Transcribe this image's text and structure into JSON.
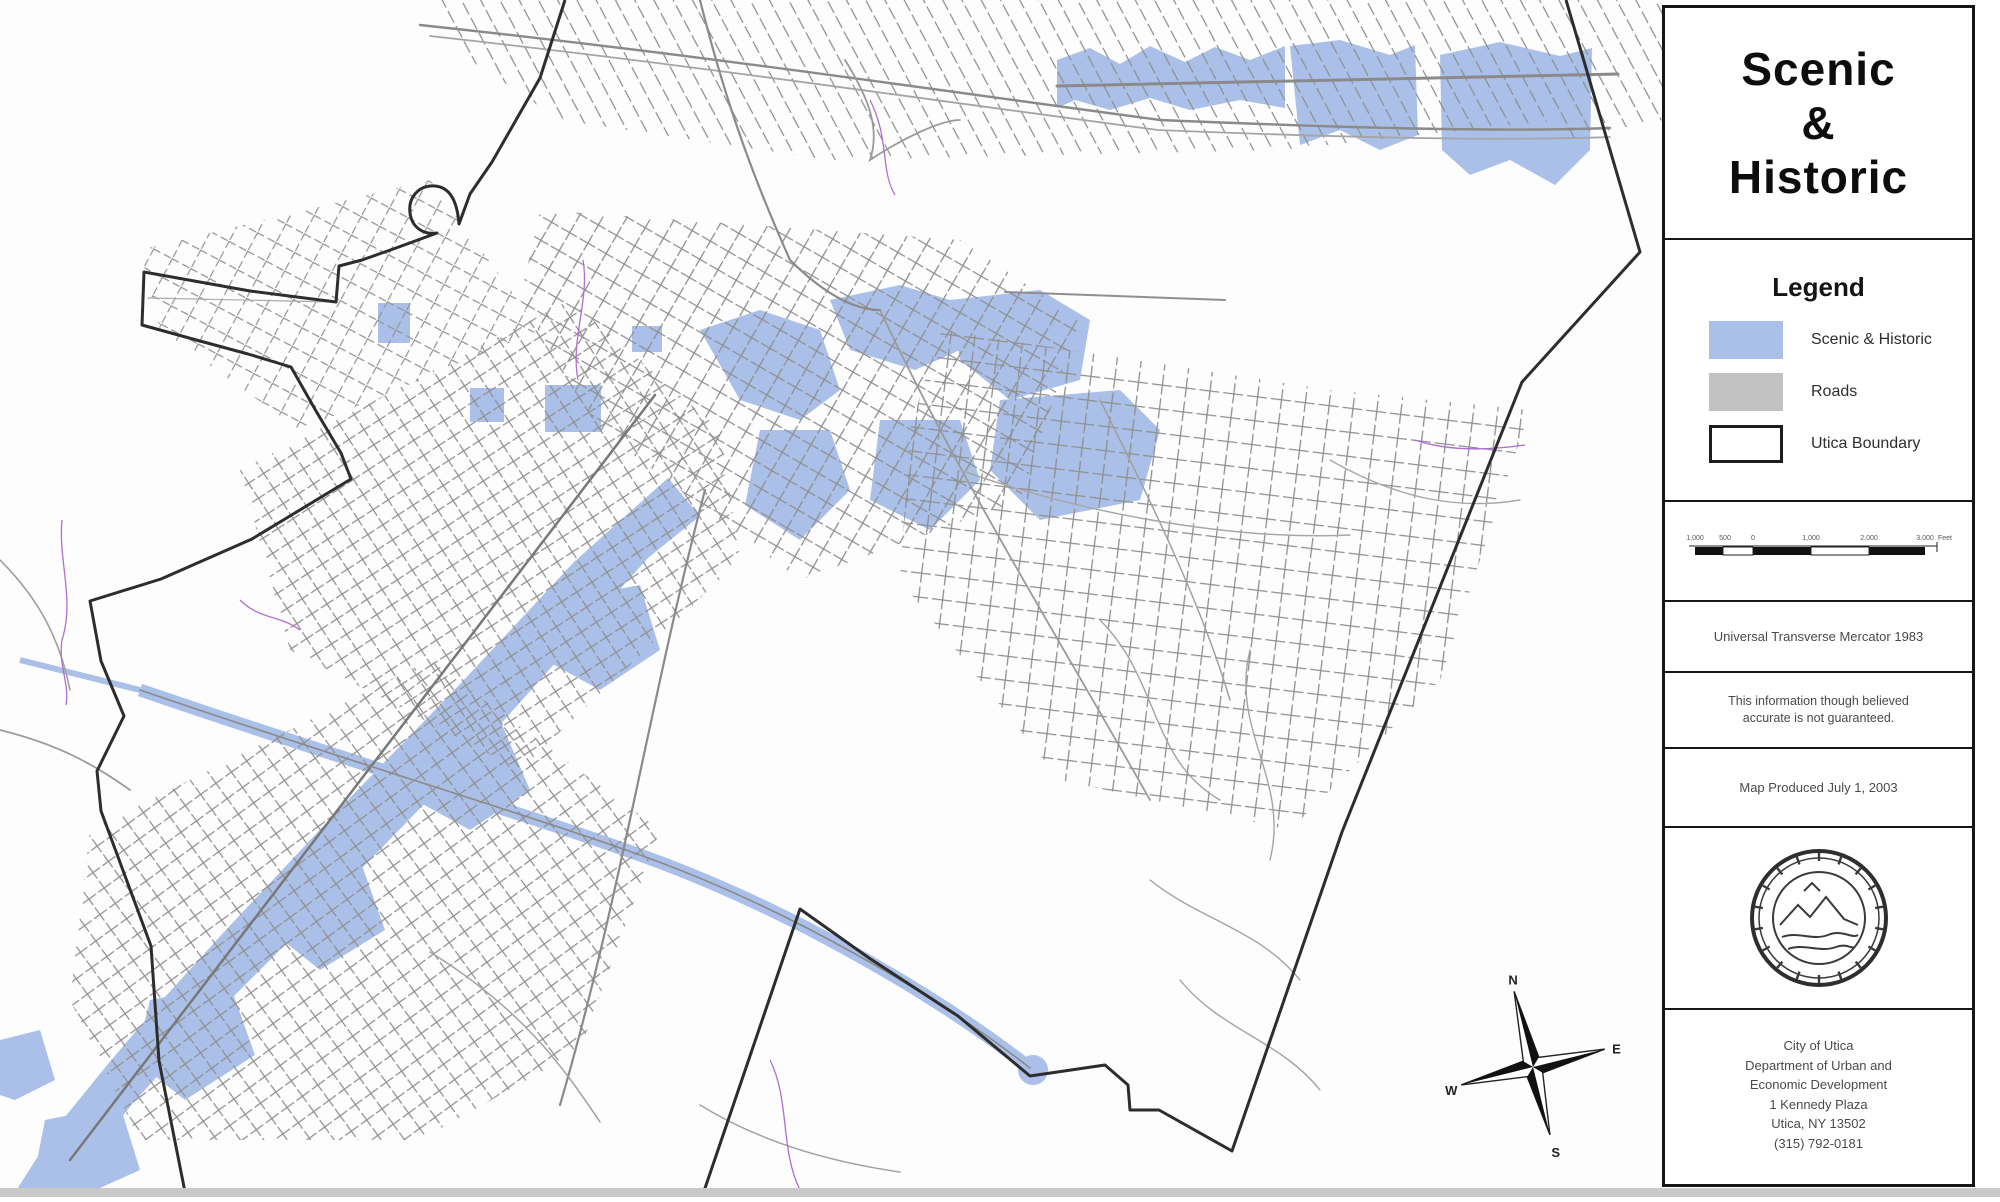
{
  "sidebar": {
    "title_lines": [
      "Scenic",
      "&",
      "Historic"
    ],
    "legend": {
      "heading": "Legend",
      "items": [
        {
          "label": "Scenic & Historic",
          "swatch": "scenic"
        },
        {
          "label": "Roads",
          "swatch": "roads"
        },
        {
          "label": "Utica Boundary",
          "swatch": "boundary"
        }
      ]
    },
    "scalebar": {
      "tick_labels": [
        "1,000",
        "500",
        "0",
        "1,000",
        "2,000",
        "3,000"
      ],
      "unit": "Feet"
    },
    "notes": {
      "projection": "Universal Transverse Mercator 1983",
      "disclaimer": "This information though believed accurate is not guaranteed.",
      "produced": "Map Produced July 1, 2003"
    },
    "seal_name": "city-of-utica-seal",
    "address_lines": [
      "City of Utica",
      "Department of Urban and",
      "Economic Development",
      "1 Kennedy Plaza",
      "Utica, NY 13502",
      "(315) 792-0181"
    ]
  },
  "map": {
    "compass": {
      "n": "N",
      "e": "E",
      "w": "W",
      "s": "S"
    },
    "colors": {
      "scenic_historic_fill": "#abc0e8",
      "roads_gray": "#8f8f8f",
      "utica_boundary": "#2d2d2d",
      "accent_purple": "#b06fd0",
      "background": "#fdfdfd"
    }
  }
}
